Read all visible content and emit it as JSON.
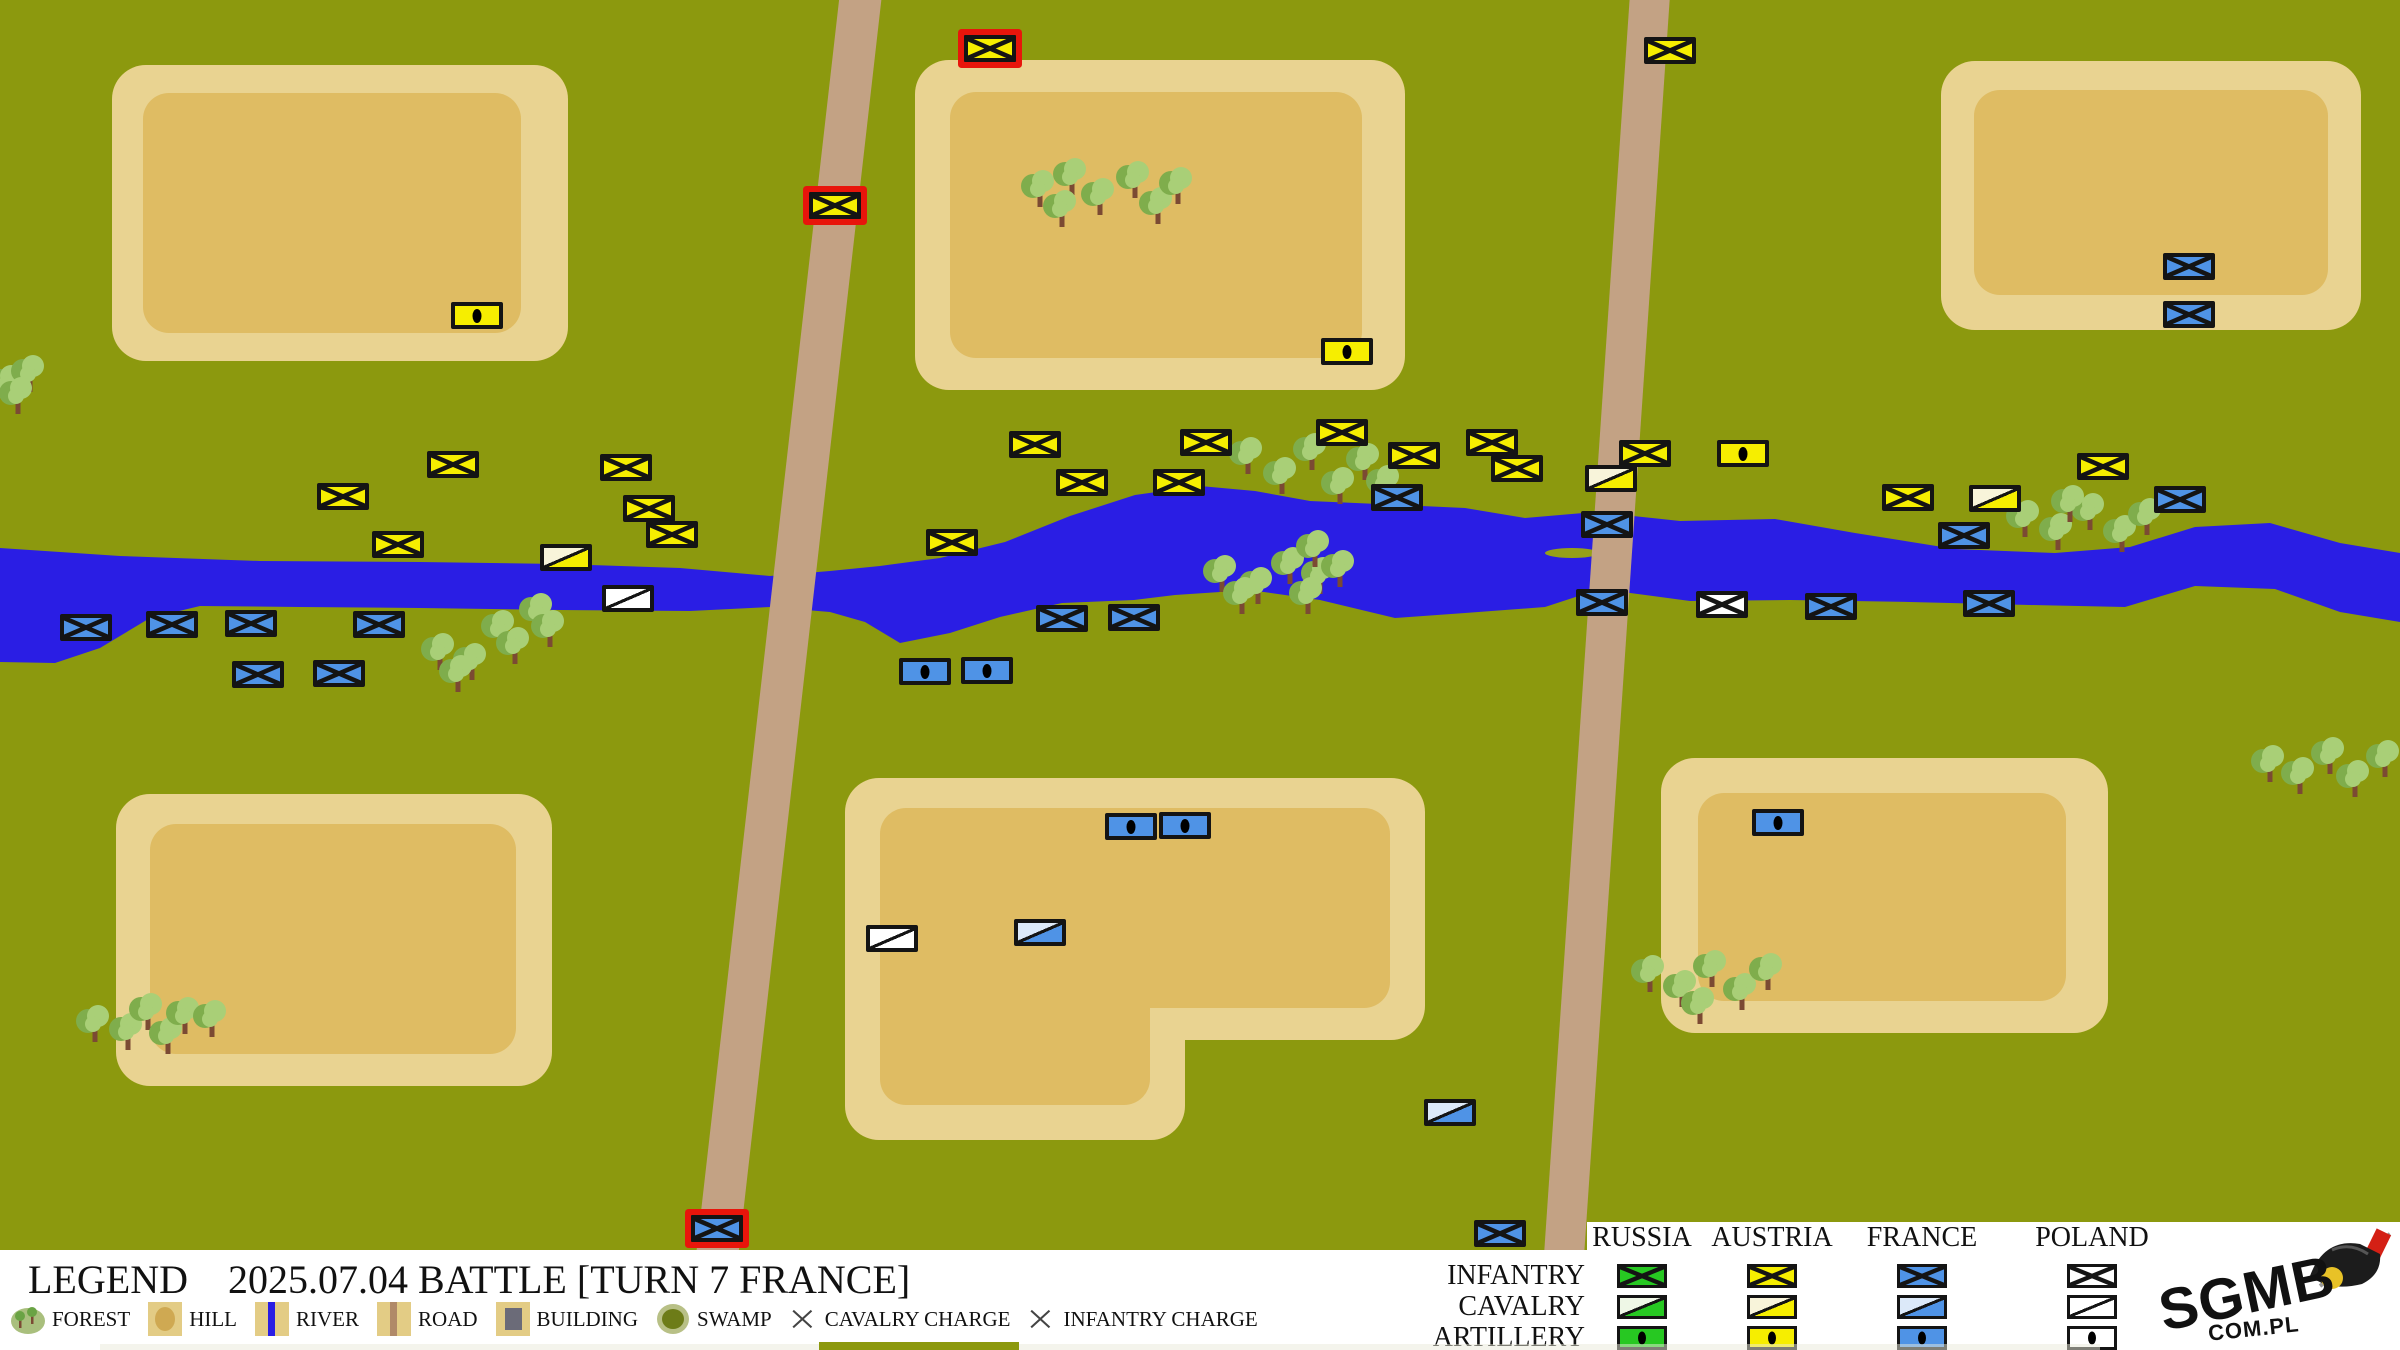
{
  "legend": {
    "title": "LEGEND",
    "battle_title": "2025.07.04 BATTLE [TURN 7 FRANCE]",
    "terrain_items": [
      {
        "id": "forest",
        "label": "FOREST"
      },
      {
        "id": "hill",
        "label": "HILL"
      },
      {
        "id": "river",
        "label": "RIVER"
      },
      {
        "id": "road",
        "label": "ROAD"
      },
      {
        "id": "building",
        "label": "BUILDING"
      },
      {
        "id": "swamp",
        "label": "SWAMP"
      },
      {
        "id": "cavalry_charge",
        "label": "CAVALRY CHARGE"
      },
      {
        "id": "infantry_charge",
        "label": "INFANTRY CHARGE"
      }
    ],
    "unit_rows": [
      "INFANTRY",
      "CAVALRY",
      "ARTILLERY"
    ],
    "logo": {
      "line1": "SGMB",
      "line2": "COM.PL"
    }
  },
  "countries": [
    {
      "id": "russia",
      "label": "RUSSIA",
      "color": "#27c822",
      "light": "#eef7e6"
    },
    {
      "id": "austria",
      "label": "AUSTRIA",
      "color": "#f6ee00",
      "light": "#f8f4da"
    },
    {
      "id": "france",
      "label": "FRANCE",
      "color": "#4f93e6",
      "light": "#dce9f9"
    },
    {
      "id": "poland",
      "label": "POLAND",
      "color": "#ffffff",
      "light": "#ffffff"
    }
  ],
  "map": {
    "colors": {
      "grass": "#8c990e",
      "river": "#2a1ee4",
      "road": "#c3a284",
      "hill_border": "#e9d391",
      "hill_fill": "#dfbc63",
      "tree_leaf": "#a9cf77",
      "tree_shadow": "#7fad4c",
      "tree_trunk": "#7b4a33",
      "charge_border": "#e8150b",
      "unit_border": "#141414",
      "island": "#96a018"
    },
    "hills": [
      {
        "name": "top-left",
        "outer": [
          112,
          65,
          456,
          296
        ],
        "inner": [
          143,
          93,
          378,
          240
        ]
      },
      {
        "name": "top-middle",
        "outer": [
          915,
          60,
          490,
          330
        ],
        "inner": [
          950,
          92,
          412,
          266
        ]
      },
      {
        "name": "top-right",
        "outer": [
          1941,
          61,
          420,
          269
        ],
        "inner": [
          1974,
          90,
          354,
          205
        ]
      },
      {
        "name": "bottom-left",
        "outer": [
          116,
          794,
          436,
          292
        ],
        "inner": [
          150,
          824,
          366,
          230
        ]
      },
      {
        "name": "bottom-middle",
        "outer": [
          845,
          778,
          580,
          262
        ],
        "outer2": [
          845,
          900,
          340,
          240
        ],
        "inner": [
          880,
          808,
          510,
          200
        ],
        "inner2": [
          880,
          930,
          270,
          175
        ]
      },
      {
        "name": "bottom-right",
        "outer": [
          1661,
          758,
          447,
          275
        ],
        "inner": [
          1698,
          793,
          368,
          208
        ]
      }
    ],
    "roads": [
      {
        "name": "west-road",
        "cx": 789,
        "cy": 625,
        "width": 42,
        "length": 1320,
        "angle": 6.5
      },
      {
        "name": "east-road",
        "cx": 1607,
        "cy": 625,
        "width": 40,
        "length": 1320,
        "angle": 3.9
      }
    ],
    "river": {
      "top": [
        [
          0,
          548
        ],
        [
          120,
          556
        ],
        [
          260,
          561
        ],
        [
          420,
          562
        ],
        [
          560,
          564
        ],
        [
          680,
          568
        ],
        [
          770,
          576
        ],
        [
          830,
          571
        ],
        [
          880,
          566
        ],
        [
          940,
          558
        ],
        [
          1005,
          542
        ],
        [
          1070,
          516
        ],
        [
          1135,
          495
        ],
        [
          1200,
          486
        ],
        [
          1255,
          491
        ],
        [
          1310,
          501
        ],
        [
          1400,
          505
        ],
        [
          1465,
          508
        ],
        [
          1525,
          518
        ],
        [
          1595,
          512
        ],
        [
          1680,
          521
        ],
        [
          1775,
          519
        ],
        [
          1855,
          533
        ],
        [
          1955,
          549
        ],
        [
          2055,
          553
        ],
        [
          2130,
          547
        ],
        [
          2195,
          527
        ],
        [
          2270,
          523
        ],
        [
          2340,
          543
        ],
        [
          2400,
          553
        ]
      ],
      "bottom": [
        [
          2400,
          622
        ],
        [
          2340,
          612
        ],
        [
          2275,
          589
        ],
        [
          2195,
          586
        ],
        [
          2125,
          607
        ],
        [
          2030,
          605
        ],
        [
          1910,
          602
        ],
        [
          1790,
          600
        ],
        [
          1690,
          601
        ],
        [
          1600,
          589
        ],
        [
          1545,
          607
        ],
        [
          1465,
          613
        ],
        [
          1395,
          618
        ],
        [
          1320,
          600
        ],
        [
          1250,
          590
        ],
        [
          1175,
          595
        ],
        [
          1134,
          600
        ],
        [
          1062,
          603
        ],
        [
          1000,
          617
        ],
        [
          950,
          633
        ],
        [
          900,
          643
        ],
        [
          865,
          622
        ],
        [
          830,
          612
        ],
        [
          770,
          607
        ],
        [
          690,
          611
        ],
        [
          560,
          610
        ],
        [
          420,
          608
        ],
        [
          300,
          607
        ],
        [
          200,
          606
        ],
        [
          150,
          618
        ],
        [
          100,
          648
        ],
        [
          55,
          663
        ],
        [
          0,
          662
        ]
      ],
      "island": {
        "x": 1572,
        "y": 553,
        "rx": 27,
        "ry": 5
      }
    },
    "trees": [
      [
        1040,
        205
      ],
      [
        1072,
        193
      ],
      [
        1062,
        225
      ],
      [
        1100,
        213
      ],
      [
        1135,
        196
      ],
      [
        1158,
        222
      ],
      [
        1178,
        202
      ],
      [
        8,
        400
      ],
      [
        30,
        390
      ],
      [
        18,
        412
      ],
      [
        440,
        668
      ],
      [
        472,
        678
      ],
      [
        500,
        645
      ],
      [
        538,
        628
      ],
      [
        458,
        690
      ],
      [
        515,
        662
      ],
      [
        550,
        645
      ],
      [
        1222,
        590
      ],
      [
        1258,
        602
      ],
      [
        1290,
        582
      ],
      [
        1320,
        592
      ],
      [
        1242,
        612
      ],
      [
        1308,
        612
      ],
      [
        1315,
        565
      ],
      [
        1340,
        585
      ],
      [
        1248,
        472
      ],
      [
        1282,
        492
      ],
      [
        1312,
        468
      ],
      [
        1340,
        502
      ],
      [
        1365,
        478
      ],
      [
        1385,
        500
      ],
      [
        2025,
        535
      ],
      [
        2058,
        548
      ],
      [
        2090,
        528
      ],
      [
        2122,
        550
      ],
      [
        2147,
        533
      ],
      [
        2070,
        520
      ],
      [
        1650,
        990
      ],
      [
        1682,
        1005
      ],
      [
        1712,
        985
      ],
      [
        1742,
        1008
      ],
      [
        1768,
        988
      ],
      [
        1700,
        1022
      ],
      [
        95,
        1040
      ],
      [
        128,
        1048
      ],
      [
        148,
        1028
      ],
      [
        168,
        1052
      ],
      [
        185,
        1032
      ],
      [
        212,
        1035
      ],
      [
        2270,
        780
      ],
      [
        2300,
        792
      ],
      [
        2330,
        772
      ],
      [
        2355,
        795
      ],
      [
        2385,
        775
      ]
    ],
    "units": [
      {
        "x": 990,
        "y": 48,
        "c": "austria",
        "t": "infantry",
        "charge": true
      },
      {
        "x": 835,
        "y": 205,
        "c": "austria",
        "t": "infantry",
        "charge": true
      },
      {
        "x": 1670,
        "y": 50,
        "c": "austria",
        "t": "infantry"
      },
      {
        "x": 477,
        "y": 315,
        "c": "austria",
        "t": "artillery"
      },
      {
        "x": 1347,
        "y": 351,
        "c": "austria",
        "t": "artillery"
      },
      {
        "x": 453,
        "y": 464,
        "c": "austria",
        "t": "infantry"
      },
      {
        "x": 343,
        "y": 496,
        "c": "austria",
        "t": "infantry"
      },
      {
        "x": 626,
        "y": 467,
        "c": "austria",
        "t": "infantry"
      },
      {
        "x": 649,
        "y": 508,
        "c": "austria",
        "t": "infantry"
      },
      {
        "x": 398,
        "y": 544,
        "c": "austria",
        "t": "infantry"
      },
      {
        "x": 672,
        "y": 534,
        "c": "austria",
        "t": "infantry"
      },
      {
        "x": 566,
        "y": 557,
        "c": "austria",
        "t": "cavalry"
      },
      {
        "x": 952,
        "y": 542,
        "c": "austria",
        "t": "infantry"
      },
      {
        "x": 1035,
        "y": 444,
        "c": "austria",
        "t": "infantry"
      },
      {
        "x": 1082,
        "y": 482,
        "c": "austria",
        "t": "infantry"
      },
      {
        "x": 1206,
        "y": 442,
        "c": "austria",
        "t": "infantry"
      },
      {
        "x": 1179,
        "y": 482,
        "c": "austria",
        "t": "infantry"
      },
      {
        "x": 1342,
        "y": 432,
        "c": "austria",
        "t": "infantry"
      },
      {
        "x": 1414,
        "y": 455,
        "c": "austria",
        "t": "infantry"
      },
      {
        "x": 1492,
        "y": 442,
        "c": "austria",
        "t": "infantry"
      },
      {
        "x": 1517,
        "y": 468,
        "c": "austria",
        "t": "infantry"
      },
      {
        "x": 1645,
        "y": 453,
        "c": "austria",
        "t": "infantry"
      },
      {
        "x": 1611,
        "y": 478,
        "c": "austria",
        "t": "cavalry"
      },
      {
        "x": 1743,
        "y": 453,
        "c": "austria",
        "t": "artillery"
      },
      {
        "x": 2103,
        "y": 466,
        "c": "austria",
        "t": "infantry"
      },
      {
        "x": 1908,
        "y": 497,
        "c": "austria",
        "t": "infantry"
      },
      {
        "x": 1995,
        "y": 498,
        "c": "austria",
        "t": "cavalry"
      },
      {
        "x": 628,
        "y": 598,
        "c": "poland",
        "t": "cavalry"
      },
      {
        "x": 892,
        "y": 938,
        "c": "poland",
        "t": "cavalry"
      },
      {
        "x": 1722,
        "y": 604,
        "c": "poland",
        "t": "infantry"
      },
      {
        "x": 86,
        "y": 627,
        "c": "france",
        "t": "infantry"
      },
      {
        "x": 172,
        "y": 624,
        "c": "france",
        "t": "infantry"
      },
      {
        "x": 251,
        "y": 623,
        "c": "france",
        "t": "infantry"
      },
      {
        "x": 379,
        "y": 624,
        "c": "france",
        "t": "infantry"
      },
      {
        "x": 258,
        "y": 674,
        "c": "france",
        "t": "infantry"
      },
      {
        "x": 339,
        "y": 673,
        "c": "france",
        "t": "infantry"
      },
      {
        "x": 1397,
        "y": 497,
        "c": "france",
        "t": "infantry"
      },
      {
        "x": 1062,
        "y": 618,
        "c": "france",
        "t": "infantry"
      },
      {
        "x": 1134,
        "y": 617,
        "c": "france",
        "t": "infantry"
      },
      {
        "x": 925,
        "y": 671,
        "c": "france",
        "t": "artillery"
      },
      {
        "x": 987,
        "y": 670,
        "c": "france",
        "t": "artillery"
      },
      {
        "x": 1607,
        "y": 524,
        "c": "france",
        "t": "infantry"
      },
      {
        "x": 1602,
        "y": 602,
        "c": "france",
        "t": "infantry"
      },
      {
        "x": 1831,
        "y": 606,
        "c": "france",
        "t": "infantry"
      },
      {
        "x": 1964,
        "y": 535,
        "c": "france",
        "t": "infantry"
      },
      {
        "x": 1989,
        "y": 603,
        "c": "france",
        "t": "infantry"
      },
      {
        "x": 2180,
        "y": 499,
        "c": "france",
        "t": "infantry"
      },
      {
        "x": 2189,
        "y": 266,
        "c": "france",
        "t": "infantry"
      },
      {
        "x": 2189,
        "y": 314,
        "c": "france",
        "t": "infantry"
      },
      {
        "x": 1131,
        "y": 826,
        "c": "france",
        "t": "artillery"
      },
      {
        "x": 1185,
        "y": 825,
        "c": "france",
        "t": "artillery"
      },
      {
        "x": 1040,
        "y": 932,
        "c": "france",
        "t": "cavalry"
      },
      {
        "x": 1450,
        "y": 1112,
        "c": "france",
        "t": "cavalry"
      },
      {
        "x": 1778,
        "y": 822,
        "c": "france",
        "t": "artillery"
      },
      {
        "x": 717,
        "y": 1228,
        "c": "france",
        "t": "infantry",
        "charge": true
      },
      {
        "x": 1500,
        "y": 1233,
        "c": "france",
        "t": "infantry"
      }
    ]
  },
  "table_layout": {
    "column_centers": [
      1642,
      1772,
      1922,
      2092
    ],
    "header_top": 1222,
    "row_centers": [
      1276,
      1307,
      1338
    ],
    "label_right": 1585
  }
}
